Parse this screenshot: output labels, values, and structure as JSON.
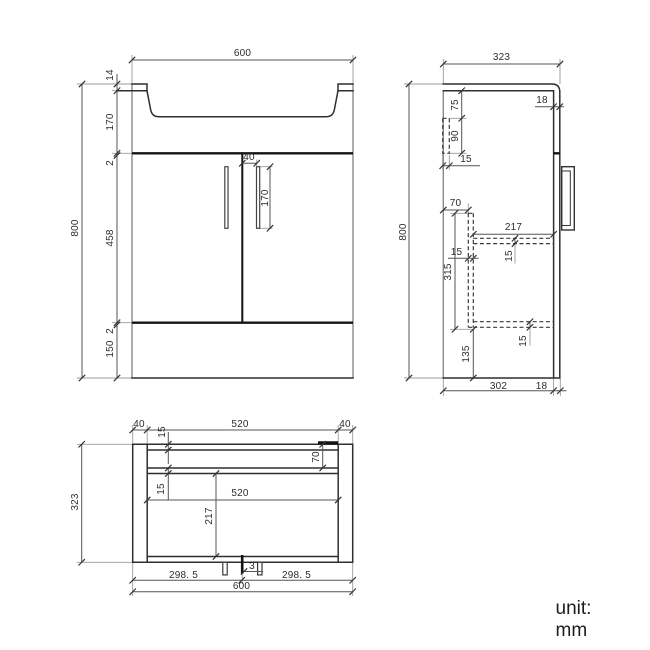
{
  "views": {
    "front": {
      "dims": {
        "overall_width": "600",
        "top_lip": "14",
        "basin_height": "170",
        "gap_top": "2",
        "door_height": "458",
        "gap_bottom": "2",
        "plinth_height": "150",
        "overall_height": "800",
        "handle_offset": "40",
        "handle_length": "170"
      }
    },
    "side": {
      "dims": {
        "overall_depth": "323",
        "panel_top_thickness": "18",
        "bracket_offset": "75",
        "bracket_height": "90",
        "bracket_thickness": "15",
        "shelf_setback": "70",
        "shelf_depth": "217",
        "divider_thickness": "15",
        "shelf_thickness": "15",
        "divider_height": "315",
        "bottom_shelf_thickness": "15",
        "bottom_clearance": "135",
        "overall_height": "800",
        "body_depth": "302",
        "door_thickness": "18"
      }
    },
    "plan": {
      "dims": {
        "side_panel_left": "40",
        "top_opening_width": "520",
        "side_panel_right": "40",
        "back_panel_thickness": "15",
        "front_setback": "70",
        "rail_thickness": "15",
        "opening_width": "520",
        "opening_depth": "217",
        "door_gap": "3",
        "door_width_left": "298. 5",
        "door_width_right": "298. 5",
        "overall_width": "600",
        "overall_depth": "323"
      }
    }
  },
  "note": {
    "unit_label": "unit: mm"
  }
}
